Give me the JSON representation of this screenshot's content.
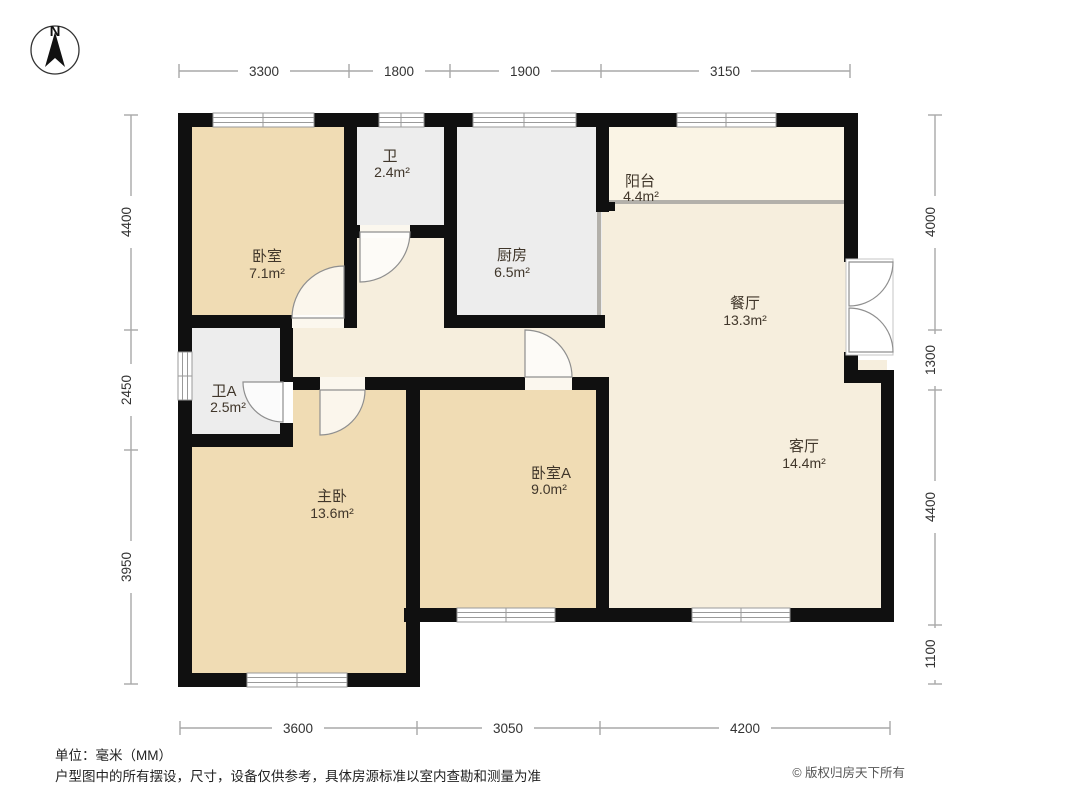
{
  "compass": {
    "label": "N"
  },
  "rooms": {
    "bedroom1": {
      "name": "卧室",
      "area": "7.1m²"
    },
    "bath1": {
      "name": "卫",
      "area": "2.4m²"
    },
    "kitchen": {
      "name": "厨房",
      "area": "6.5m²"
    },
    "balcony": {
      "name": "阳台",
      "area": "4.4m²"
    },
    "dining": {
      "name": "餐厅",
      "area": "13.3m²"
    },
    "living": {
      "name": "客厅",
      "area": "14.4m²"
    },
    "bathA": {
      "name": "卫A",
      "area": "2.5m²"
    },
    "master": {
      "name": "主卧",
      "area": "13.6m²"
    },
    "bedroomA": {
      "name": "卧室A",
      "area": "9.0m²"
    }
  },
  "dimensions": {
    "top": [
      "3300",
      "1800",
      "1900",
      "3150"
    ],
    "left": [
      "4400",
      "2450",
      "3950"
    ],
    "right": [
      "4000",
      "1300",
      "4400",
      "1100"
    ],
    "bottom": [
      "3600",
      "3050",
      "4200"
    ]
  },
  "footer": {
    "unit_note": "单位：毫米（MM）",
    "disclaimer": "户型图中的所有摆设，尺寸，设备仅供参考，具体房源标准以室内查勘和测量为准",
    "copyright": "© 版权归房天下所有"
  },
  "colors": {
    "wall": "#101010",
    "room_tan": "#f0dcb4",
    "room_gray": "#ededed",
    "open_cream": "#f6eedd",
    "balcony_cream": "#faf4e5",
    "dim_line": "#a8a8a8",
    "window_frame": "#9a9a9a"
  }
}
